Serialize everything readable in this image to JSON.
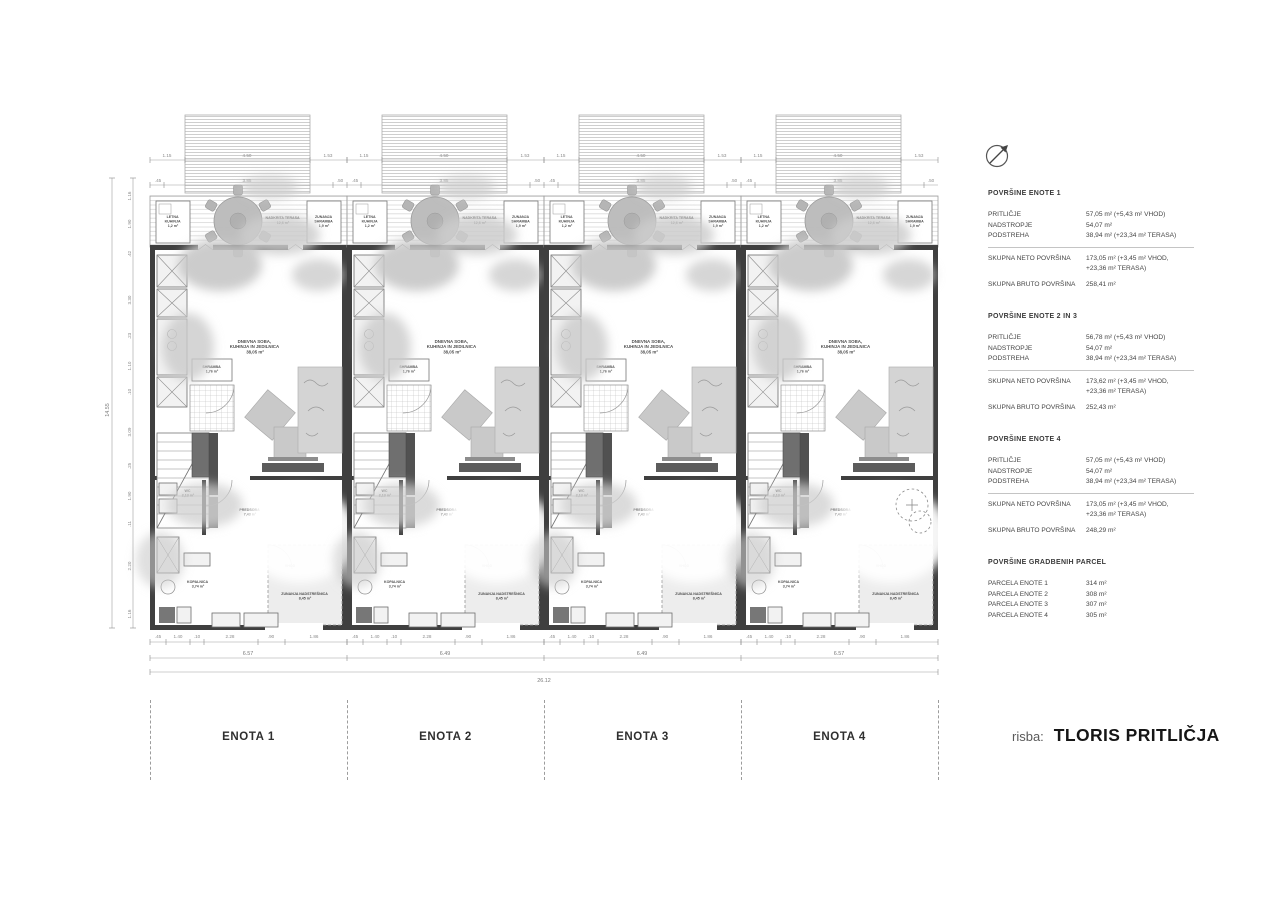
{
  "drawing": {
    "label_prefix": "risba:",
    "title": "TLORIS PRITLIČJA"
  },
  "units": {
    "labels": [
      "ENOTA 1",
      "ENOTA 2",
      "ENOTA 3",
      "ENOTA 4"
    ]
  },
  "plan": {
    "rooms": {
      "summer_kitchen": [
        "LETNA",
        "KUHINJA",
        "1,2 m²"
      ],
      "outdoor_storage": [
        "ZUNANJA",
        "SHRAMBA",
        "1,9 m²"
      ],
      "covered_terrace": [
        "NADKRITA TERASA",
        "12,6 m²"
      ],
      "living": [
        "DNEVNA SOBA,",
        "KUHINJA IN JEDILNICA",
        "38,05 m²"
      ],
      "pantry": [
        "SHRAMBA",
        "1,76 m²"
      ],
      "wc": [
        "WC",
        "2,13 m²"
      ],
      "hall": [
        "PREDSOBA",
        "7,43 m²"
      ],
      "bath": [
        "KOPALNICA",
        "3,74 m²"
      ],
      "entrance": "VHOD",
      "canopy": [
        "ZUNANJA NADSTREŠNICA",
        "8,45 m²"
      ]
    },
    "dims": {
      "top_row1": [
        "1.15",
        "4.50",
        "1.53"
      ],
      "top_row2": [
        ".45",
        "3.85",
        ".50"
      ],
      "bottom_row1": [
        ".45",
        "1.40",
        ".10",
        "2.28",
        ".90",
        "1.86"
      ],
      "bottom_totals": [
        "6.57",
        "6.49",
        "6.49",
        "6.57"
      ],
      "bottom_overall": "26.12",
      "left_chain": [
        "1.16",
        "1.90",
        ".42",
        "3.30",
        ".23",
        "1.10",
        ".10",
        "3.09",
        ".25",
        "1.90",
        ".11",
        "2.20",
        "1.16"
      ],
      "left_overall": "14.55"
    }
  },
  "legend": {
    "blocks": [
      {
        "heading": "POVRŠINE ENOTE 1",
        "rows": [
          [
            "PRITLIČJE",
            "57,05 m² (+5,43 m² VHOD)"
          ],
          [
            "NADSTROPJE",
            "54,07 m²"
          ],
          [
            "PODSTREHA",
            "38,94 m² (+23,34 m² TERASA)"
          ]
        ],
        "totals": [
          [
            "SKUPNA NETO POVRŠINA",
            [
              "173,05 m² (+3,45 m² VHOD,",
              "+23,36 m² TERASA)"
            ]
          ],
          [
            "SKUPNA BRUTO POVRŠINA",
            "258,41 m²"
          ]
        ]
      },
      {
        "heading": "POVRŠINE ENOTE 2 IN 3",
        "rows": [
          [
            "PRITLIČJE",
            "56,78 m² (+5,43 m² VHOD)"
          ],
          [
            "NADSTROPJE",
            "54,07 m²"
          ],
          [
            "PODSTREHA",
            "38,94 m² (+23,34 m² TERASA)"
          ]
        ],
        "totals": [
          [
            "SKUPNA NETO POVRŠINA",
            [
              "173,62 m² (+3,45 m² VHOD,",
              "+23,36 m² TERASA)"
            ]
          ],
          [
            "SKUPNA BRUTO POVRŠINA",
            "252,43 m²"
          ]
        ]
      },
      {
        "heading": "POVRŠINE ENOTE 4",
        "rows": [
          [
            "PRITLIČJE",
            "57,05 m² (+5,43 m² VHOD)"
          ],
          [
            "NADSTROPJE",
            "54,07 m²"
          ],
          [
            "PODSTREHA",
            "38,94 m² (+23,34 m² TERASA)"
          ]
        ],
        "totals": [
          [
            "SKUPNA NETO POVRŠINA",
            [
              "173,05 m² (+3,45 m² VHOD,",
              "+23,36 m² TERASA)"
            ]
          ],
          [
            "SKUPNA BRUTO POVRŠINA",
            "248,29 m²"
          ]
        ]
      }
    ],
    "parcels": {
      "heading": "POVRŠINE GRADBENIH PARCEL",
      "rows": [
        [
          "PARCELA ENOTE 1",
          "314 m²"
        ],
        [
          "PARCELA ENOTE 2",
          "308 m²"
        ],
        [
          "PARCELA ENOTE 3",
          "307 m²"
        ],
        [
          "PARCELA ENOTE 4",
          "305 m²"
        ]
      ]
    }
  },
  "icons": {
    "north_arrow": "north-arrow"
  }
}
